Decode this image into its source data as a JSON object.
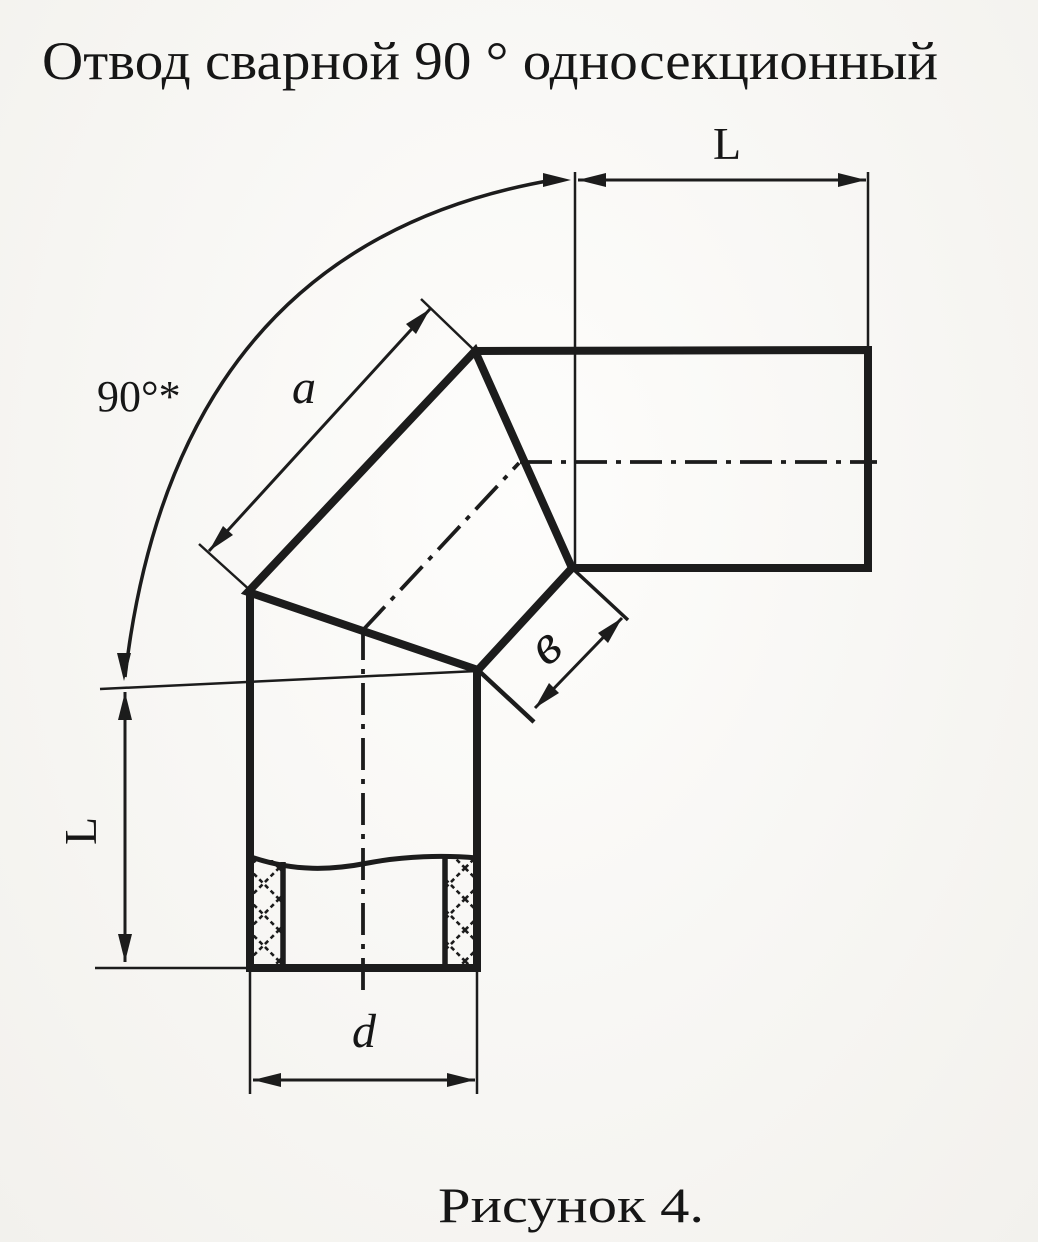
{
  "page": {
    "title": "Отвод сварной 90 ° односекционный",
    "caption": "Рисунок 4.",
    "paper_color": "#fcfbf8",
    "ink_color": "#1c1c1c"
  },
  "figure": {
    "labels": {
      "angle": "90°*",
      "length_top": "L",
      "length_left": "L",
      "segment_side": "a",
      "joint_width": "в",
      "diameter": "d"
    }
  }
}
